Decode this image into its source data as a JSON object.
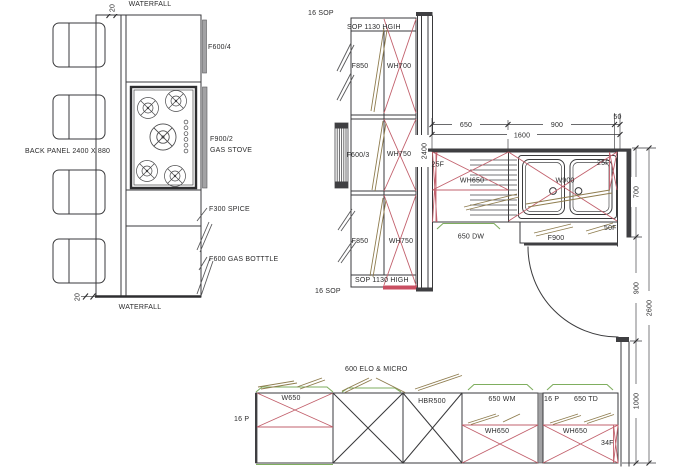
{
  "title": "Kitchen layout CAD plan",
  "colors": {
    "line": "#3a3a3c",
    "cross_red": "#c2606c",
    "accent_red": "#c94f62",
    "swing_olive": "#8f7d4f",
    "counter_green": "#7fae5f",
    "wall_gray": "#3f3f42",
    "filler_gray": "#a2a2a4"
  },
  "island": {
    "waterfall_top": "WATERFALL",
    "waterfall_bottom": "WATERFALL",
    "back_panel": "BACK PANEL 2400 X 880",
    "dim_waterfall_top": "20",
    "dim_waterfall_bottom": "20",
    "f600_4": "F600/4",
    "f900_2": "F900/2",
    "gas_stove": "GAS STOVE",
    "f300_spice": "F300 SPICE",
    "f600_gas_bottle": "F600 GAS BOTTTLE"
  },
  "tall_units": {
    "sop16_top": "16 SOP",
    "sop1130_top": "SOP 1130 HGIH",
    "f850_top": "F850",
    "wh700": "WH700",
    "f600_3": "F600/3",
    "wh750_mid": "WH750",
    "f850_bottom": "F850",
    "wh750_bottom": "WH750",
    "sop1130_bottom": "SOP 1130 HIGH",
    "sop16_bottom": "16 SOP",
    "dim_height": "2400"
  },
  "sink_run": {
    "dim_650": "650",
    "dim_900": "900",
    "dim_50": "50",
    "dim_1600": "1600",
    "f25_left": "25F",
    "wh650": "WH650",
    "w900": "W900",
    "f25_right": "25F",
    "dw_650": "650 DW",
    "f900": "F900",
    "f50": "50F",
    "dim_700": "700",
    "dim_900_v": "900",
    "dim_2600": "2600",
    "dim_1000": "1000"
  },
  "base_row": {
    "elo_micro": "600 ELO & MICRO",
    "p16_left": "16 P",
    "w650": "W650",
    "hbr500": "HBR500",
    "wm_650": "650 WM",
    "p16_mid": "16 P",
    "td_650": "650 TD",
    "wh650_left": "WH650",
    "wh650_right": "WH650",
    "f34": "34F"
  }
}
